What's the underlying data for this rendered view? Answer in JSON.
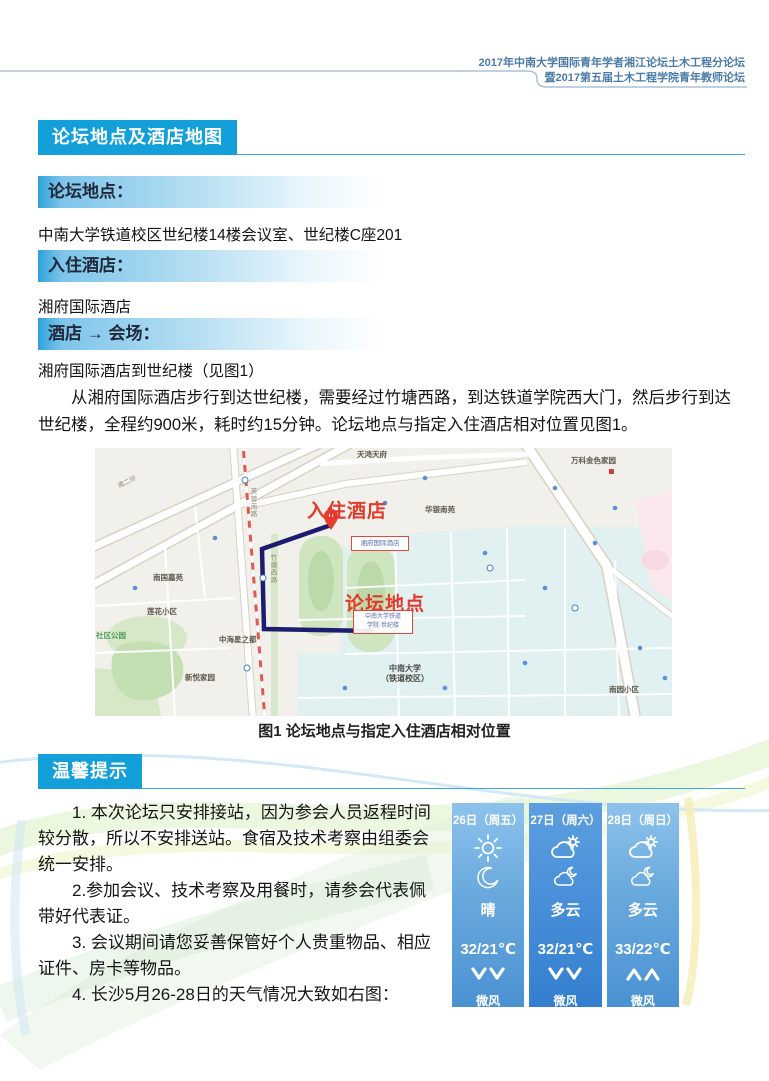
{
  "page_header": {
    "line1": "2017年中南大学国际青年学者湘江论坛土木工程分论坛",
    "line2": "暨2017第五届土木工程学院青年教师论坛"
  },
  "section_map": {
    "title": "论坛地点及酒店地图",
    "items": [
      {
        "heading": "论坛地点：",
        "body": "中南大学铁道校区世纪楼14楼会议室、世纪楼C座201"
      },
      {
        "heading": "入住酒店：",
        "body": "湘府国际酒店"
      },
      {
        "heading": "酒店 → 会场：",
        "body": "湘府国际酒店到世纪楼（见图1）"
      }
    ],
    "paragraph": "从湘府国际酒店步行到达世纪楼，需要经过竹塘西路，到达铁道学院西大门，然后步行到达世纪楼，全程约900米，耗时约15分钟。论坛地点与指定入住酒店相对位置见图1。",
    "figure_caption": "图1 论坛地点与指定入住酒店相对位置"
  },
  "map": {
    "hotel_label": "入住酒店",
    "forum_label": "论坛地点",
    "hotel_box": "湘府国际酒店",
    "forum_box_line1": "中南大学铁道",
    "forum_box_line2": "学院·世纪楼",
    "campus_line1": "中南大学",
    "campus_line2": "（铁道校区）",
    "pin_icon": "map-pin-icon",
    "small_labels": [
      "天鸿天府",
      "万科金色家园",
      "华银南苑",
      "南国嘉苑",
      "莲花小区",
      "社区公园",
      "中海星之都",
      "新悦家园",
      "南园小区",
      "南二环",
      "芙蓉南路",
      "竹塘西路"
    ]
  },
  "section_tips": {
    "title": "温馨提示",
    "tips": [
      "1. 本次论坛只安排接站，因为参会人员返程时间较分散，所以不安排送站。食宿及技术考察由组委会统一安排。",
      "2.参加会议、技术考察及用餐时，请参会代表佩带好代表证。",
      "3. 会议期间请您妥善保管好个人贵重物品、相应证件、房卡等物品。",
      "4. 长沙5月26-28日的天气情况大致如右图："
    ]
  },
  "weather": {
    "days": [
      {
        "label": "26日（周五）",
        "day_icon": "sun-icon",
        "night_icon": "moon-icon",
        "condition": "晴",
        "temp": "32/21℃",
        "wind_direction": "down",
        "wind": "微风"
      },
      {
        "label": "27日（周六）",
        "day_icon": "cloud-sun-icon",
        "night_icon": "cloud-moon-icon",
        "condition": "多云",
        "temp": "32/21℃",
        "wind_direction": "down",
        "wind": "微风"
      },
      {
        "label": "28日（周日）",
        "day_icon": "cloud-sun-icon",
        "night_icon": "cloud-moon-icon",
        "condition": "多云",
        "temp": "33/22℃",
        "wind_direction": "up",
        "wind": "微风"
      }
    ]
  },
  "colors": {
    "accent_blue": "#129fda",
    "header_text_blue": "#4b7ba8",
    "map_red": "#e23a2c",
    "route_navy": "#1d1d70",
    "weather_card_blue": "#4b92d3",
    "weather_card_mid_blue": "#337fce"
  }
}
